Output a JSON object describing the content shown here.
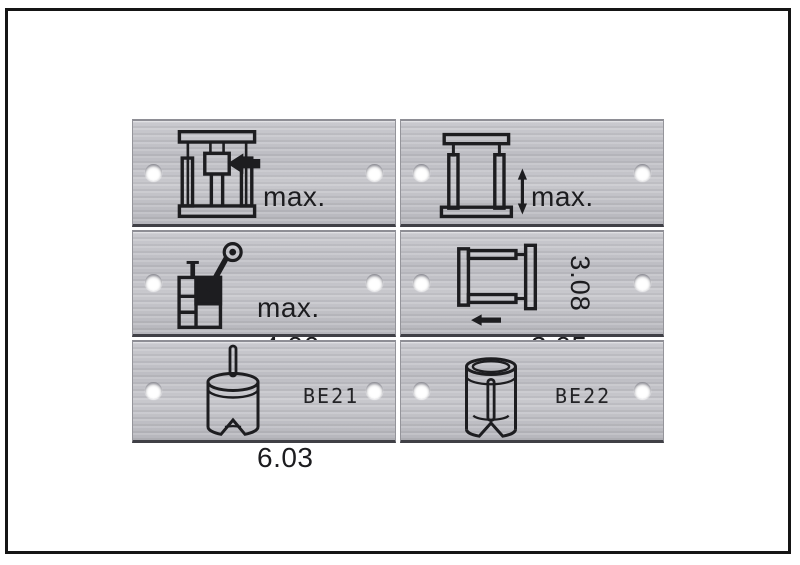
{
  "palette": {
    "frame_border": "#151515",
    "page_background": "#ffffff",
    "plate_metal_light": "#cacacf",
    "plate_metal_dark": "#b6b6bc",
    "plate_bottom_edge": "#404046",
    "engraving_ink": "#1d1d20",
    "hole_white": "#ffffff"
  },
  "plates": [
    {
      "icon": "press-ram-left-arrow-icon",
      "lines": [
        "max.",
        "6 bar",
        "4.06"
      ]
    },
    {
      "icon": "guide-frame-vertical-double-arrow-icon",
      "lines": [
        "max.",
        "6 bar",
        "3.05"
      ]
    },
    {
      "icon": "hand-oil-pump-icon",
      "lines": [
        "max.",
        "3,5 bar",
        "6.03"
      ]
    },
    {
      "icon": "guide-frame-horizontal-left-arrow-icon",
      "rotated_label": "3.08"
    },
    {
      "icon": "pin-cylinder-icon",
      "label": "BE21"
    },
    {
      "icon": "socket-cylinder-icon",
      "label": "BE22"
    }
  ]
}
